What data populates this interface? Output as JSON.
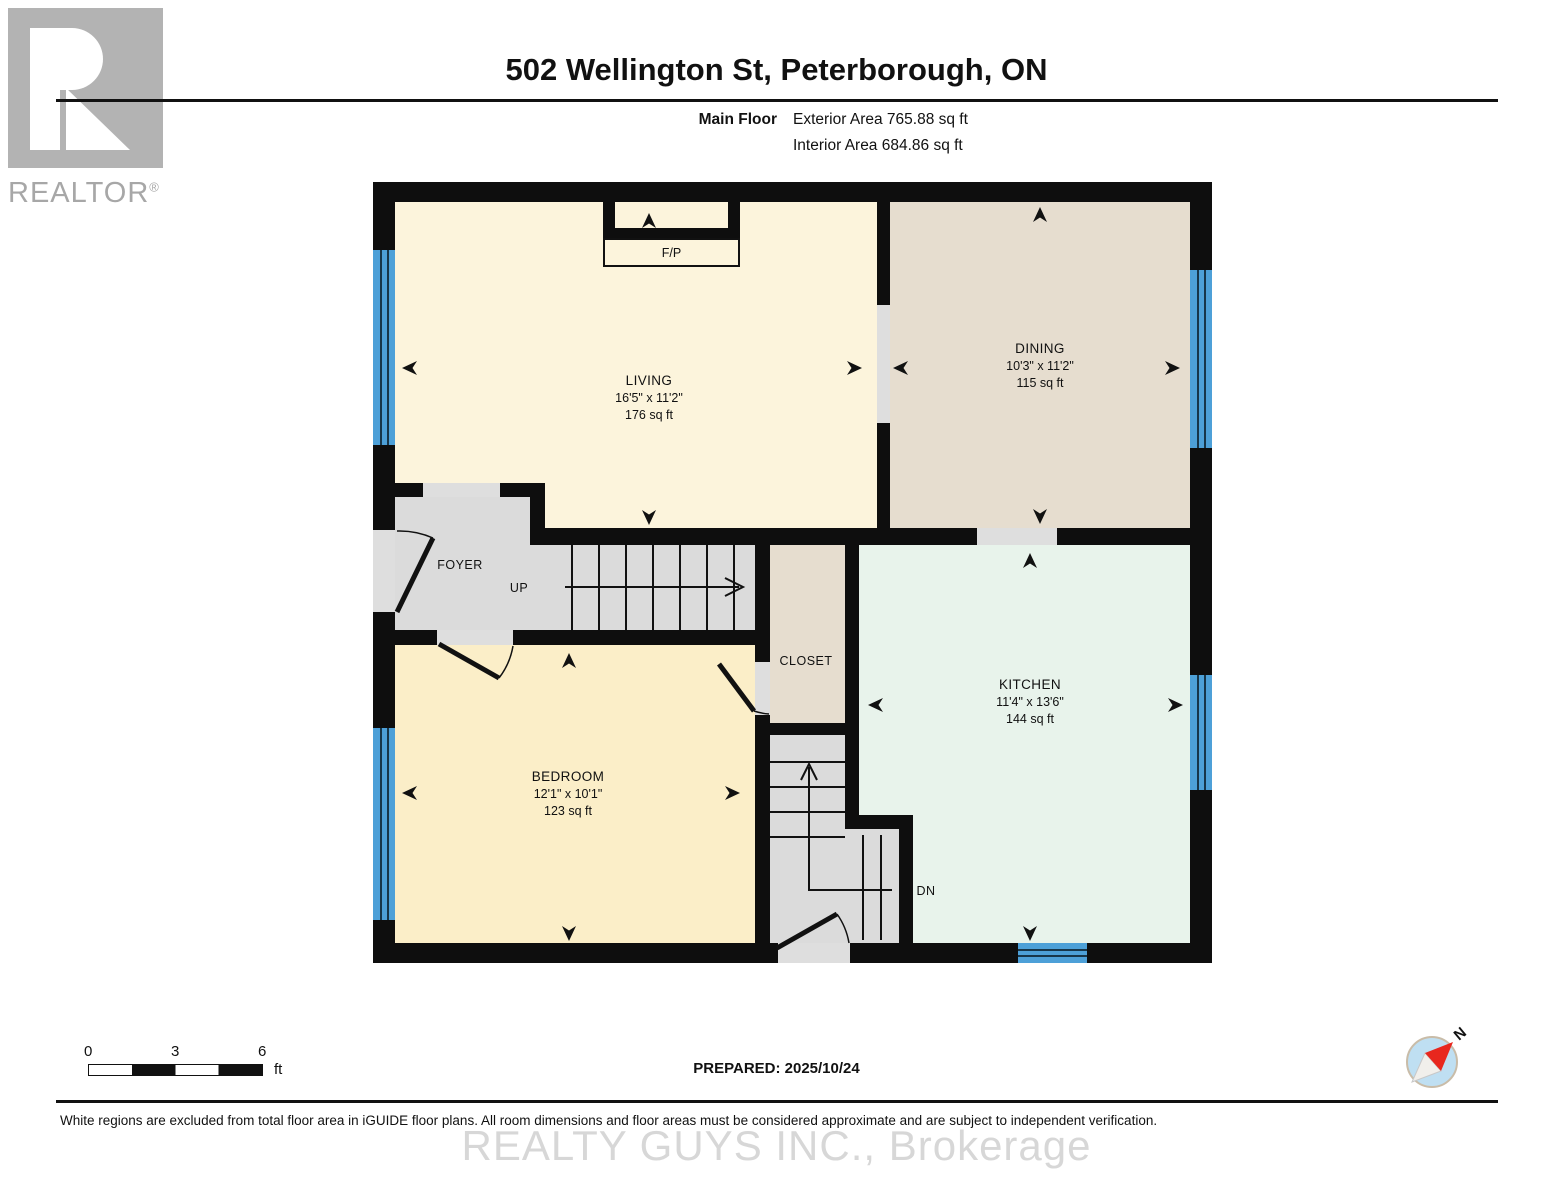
{
  "header": {
    "logo_text": "REALTOR",
    "logo_reg": "®",
    "title": "502 Wellington St, Peterborough, ON",
    "floor_label": "Main Floor",
    "exterior_area": "Exterior Area 765.88 sq ft",
    "interior_area": "Interior Area 684.86 sq ft"
  },
  "rooms": {
    "living": {
      "name": "LIVING",
      "dims": "16'5\" x 11'2\"",
      "area": "176 sq ft"
    },
    "dining": {
      "name": "DINING",
      "dims": "10'3\" x 11'2\"",
      "area": "115 sq ft"
    },
    "kitchen": {
      "name": "KITCHEN",
      "dims": "11'4\" x 13'6\"",
      "area": "144 sq ft"
    },
    "bedroom": {
      "name": "BEDROOM",
      "dims": "12'1\" x 10'1\"",
      "area": "123 sq ft"
    },
    "foyer": {
      "name": "FOYER"
    },
    "closet": {
      "name": "CLOSET"
    },
    "fireplace": {
      "name": "F/P"
    },
    "stairs_up": {
      "label": "UP"
    },
    "stairs_down": {
      "label": "DN"
    }
  },
  "footer": {
    "scale": {
      "ticks": [
        "0",
        "3",
        "6"
      ],
      "unit": "ft"
    },
    "prepared": "PREPARED: 2025/10/24",
    "compass_label": "N",
    "disclaimer": "White regions are excluded from total floor area in iGUIDE floor plans. All room dimensions and floor areas must be considered approximate and are subject to independent verification.",
    "watermark": "REALTY GUYS INC., Brokerage"
  },
  "colors": {
    "wall": "#0E0E0E",
    "living_fill": "#FCF4DC",
    "bedroom_fill": "#FBEEC8",
    "dining_fill": "#E6DDCF",
    "kitchen_fill": "#E8F3EB",
    "hall_fill": "#DBDBDB",
    "window_blue": "#4DA0D8",
    "compass_red": "#E8271E"
  }
}
